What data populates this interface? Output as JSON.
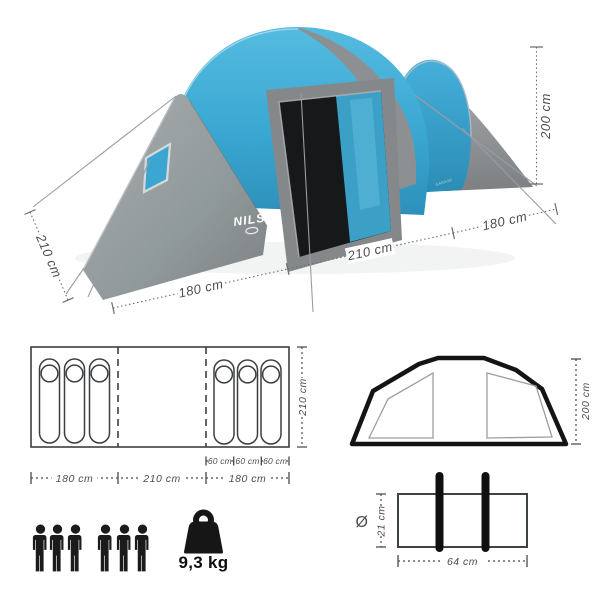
{
  "product": {
    "brand": "NILS",
    "registered_mark": "®",
    "model_text": "GARAGE"
  },
  "tent_photo": {
    "dimensions": {
      "height": "200 cm",
      "side_depth": "210 cm",
      "front_left": "180 cm",
      "front_center": "210 cm",
      "front_right": "180 cm"
    },
    "colors": {
      "canopy_blue": "#3aa8d2",
      "canopy_gray": "#8f9294",
      "interior_dark": "#17191b"
    }
  },
  "floor_plan": {
    "depth_label": "210 cm",
    "width_segments": [
      "180 cm",
      "210 cm",
      "180 cm"
    ],
    "bed_widths": [
      "60 cm",
      "60 cm",
      "60 cm"
    ],
    "sleeping_bags_left": 3,
    "sleeping_bags_right": 3
  },
  "front_view": {
    "height_label": "200 cm"
  },
  "pack_bag": {
    "diameter_symbol": "Ø",
    "diameter_label": "21 cm",
    "length_label": "64 cm"
  },
  "capacity": {
    "persons": 6,
    "weight_label": "9,3 kg"
  }
}
